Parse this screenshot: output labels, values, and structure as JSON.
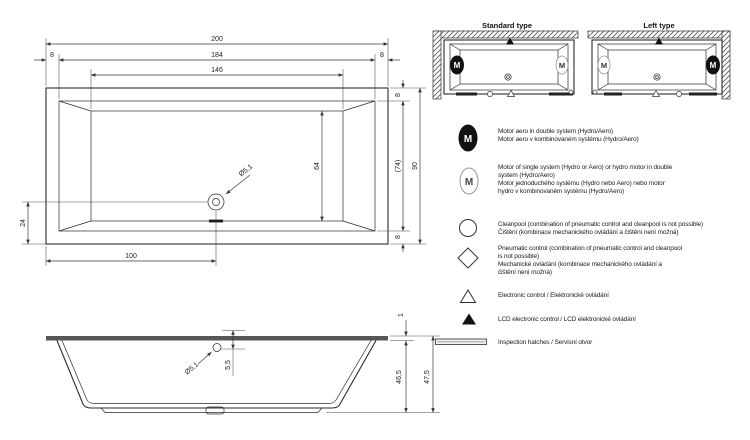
{
  "drawing": {
    "plan": {
      "dims": {
        "overall_length": "200",
        "rim_left": "8",
        "inner_length": "184",
        "rim_right": "8",
        "basin_length": "146",
        "rim_top": "8",
        "inner_width": "(74)",
        "overall_width": "90",
        "rim_bottom": "8",
        "basin_width": "64",
        "drain_diameter": "Ø5,1",
        "drain_from_bottom": "24",
        "drain_from_left": "100"
      }
    },
    "side": {
      "dims": {
        "rim_height": "1",
        "overflow_diameter": "Ø5,1",
        "overflow_depth": "5,5",
        "inner_depth": "46,5",
        "overall_height": "47,5"
      }
    }
  },
  "types": {
    "standard": {
      "label": "Standard type",
      "motor_left": "M",
      "motor_right": "M"
    },
    "left": {
      "label": "Left type",
      "motor_left": "M",
      "motor_right": "M"
    }
  },
  "legend": {
    "items": [
      {
        "symbol": "motor-double-icon",
        "motor_letter": "M",
        "lines": [
          "Motor aero in double system (Hydro/Aero)",
          "Motor aero v kombinovaném systému (Hydro/Aero)"
        ]
      },
      {
        "symbol": "motor-single-icon",
        "motor_letter": "M",
        "lines": [
          "Motor of single system (Hydro or Aero) or hydro motor in double",
          "system (Hydro/Aero)",
          "Motor jednoduchého systému (Hydro nebo Aero) nebo motor",
          "hydro v kombinovaném systému (Hydro/Aero)"
        ]
      },
      {
        "symbol": "cleanpool-icon",
        "lines": [
          "Cleanpool (combination of pneumatic control and cleanpool is not possible)",
          "Čištění (kombinace mechanického ovládání a čištění není možná)"
        ]
      },
      {
        "symbol": "pneumatic-control-icon",
        "lines": [
          "Pneumatic control (combination of pneumatic control and cleanpool",
          "is not possible)",
          "Mechanické ovládání (kombinace mechanického ovládání a",
          "čištění není možná)"
        ]
      },
      {
        "symbol": "electronic-control-icon",
        "lines": [
          "Electronic control / Elektronické ovládání"
        ]
      },
      {
        "symbol": "lcd-control-icon",
        "lines": [
          "LCD electronic control / LCD elektronické ovládání"
        ]
      },
      {
        "symbol": "inspection-hatch-icon",
        "lines": [
          "Inspection hatches / Servisní otvor"
        ]
      }
    ]
  }
}
